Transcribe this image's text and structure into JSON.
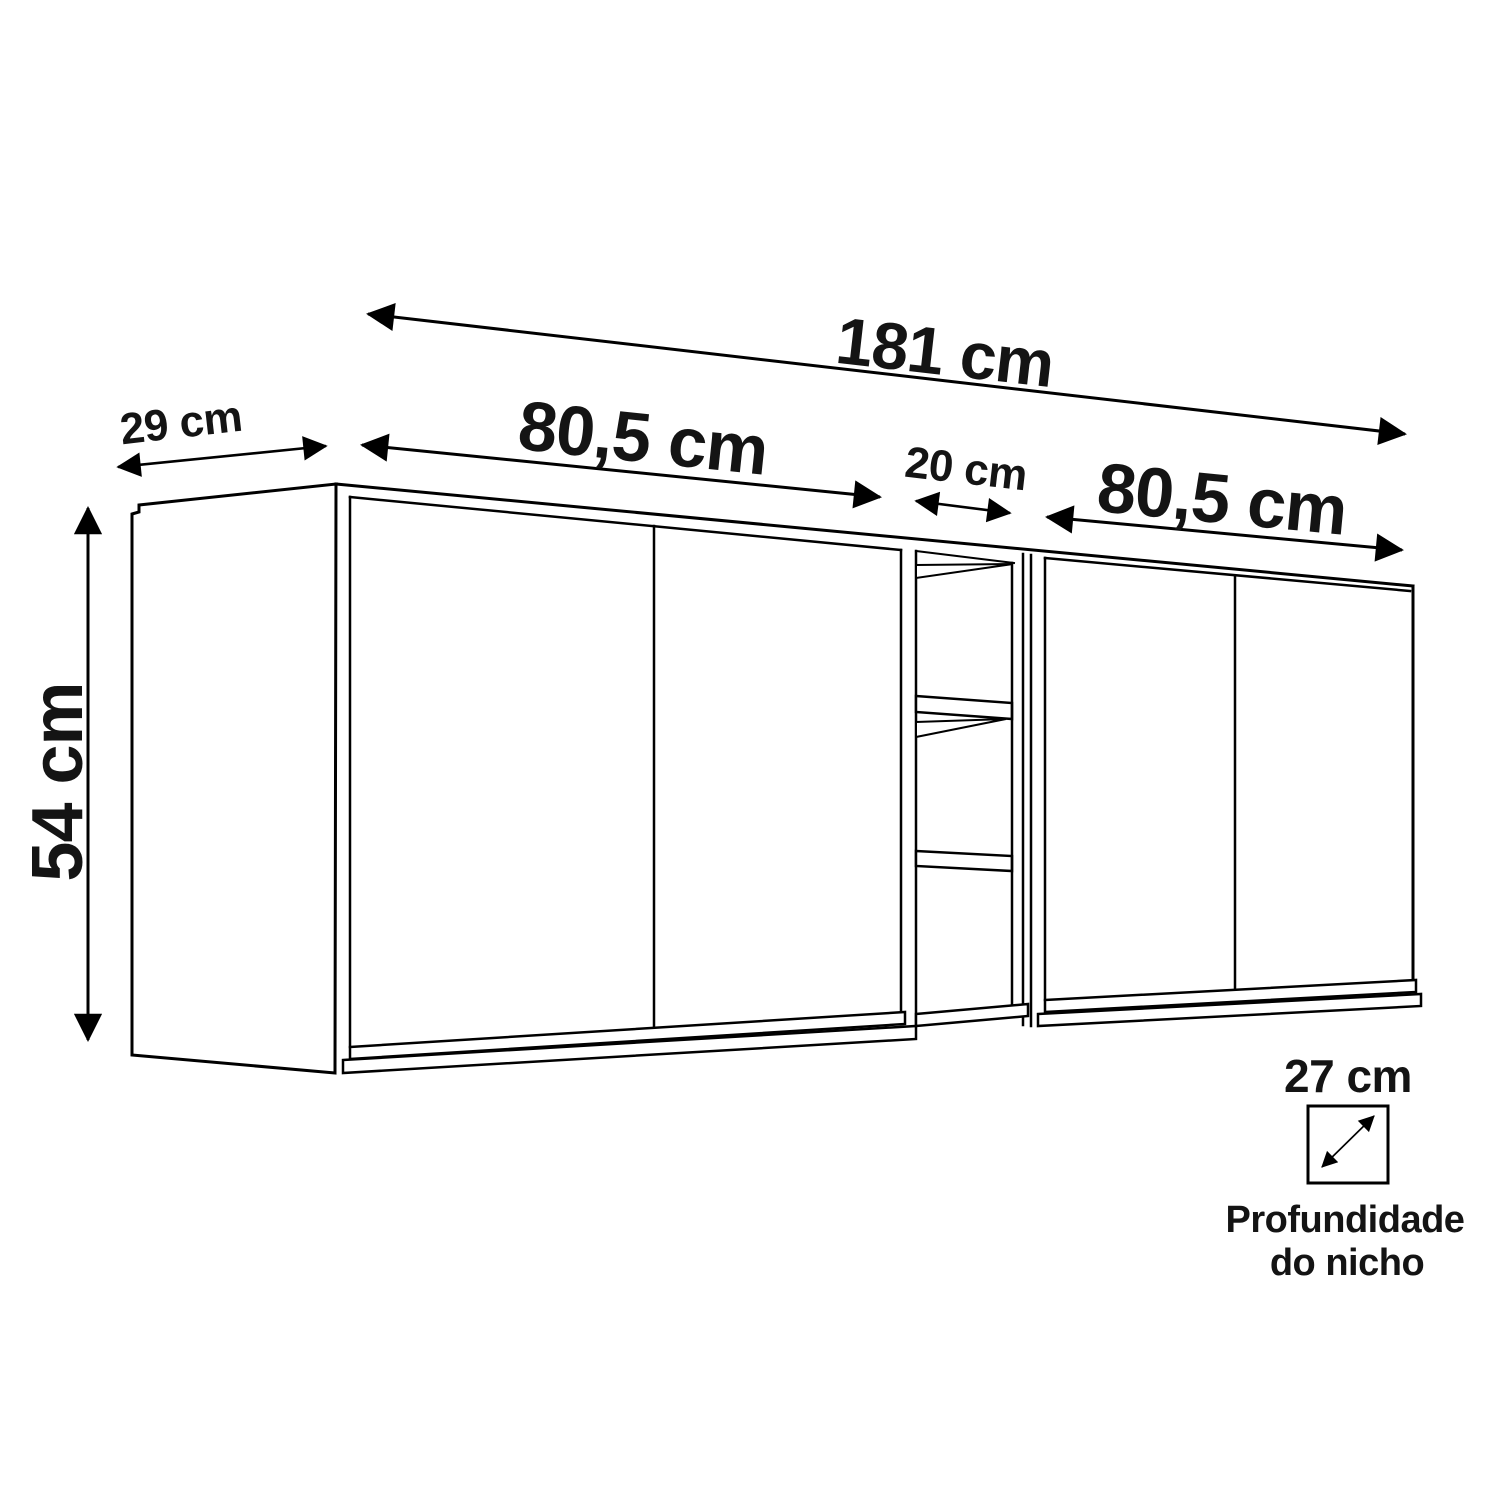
{
  "page": {
    "background": "#ffffff"
  },
  "diagram": {
    "line_color": "#000000",
    "text_color": "#141414",
    "dimensions": {
      "total_width": "181 cm",
      "left_module_width": "80,5 cm",
      "niche_width": "20 cm",
      "right_module_width": "80,5 cm",
      "side_depth": "29 cm",
      "height": "54 cm",
      "niche_depth": "27 cm"
    },
    "caption": {
      "line1": "Profundidade",
      "line2": "do nicho"
    },
    "icons": {
      "niche_depth": "diagonal-double-arrow-in-square"
    }
  }
}
